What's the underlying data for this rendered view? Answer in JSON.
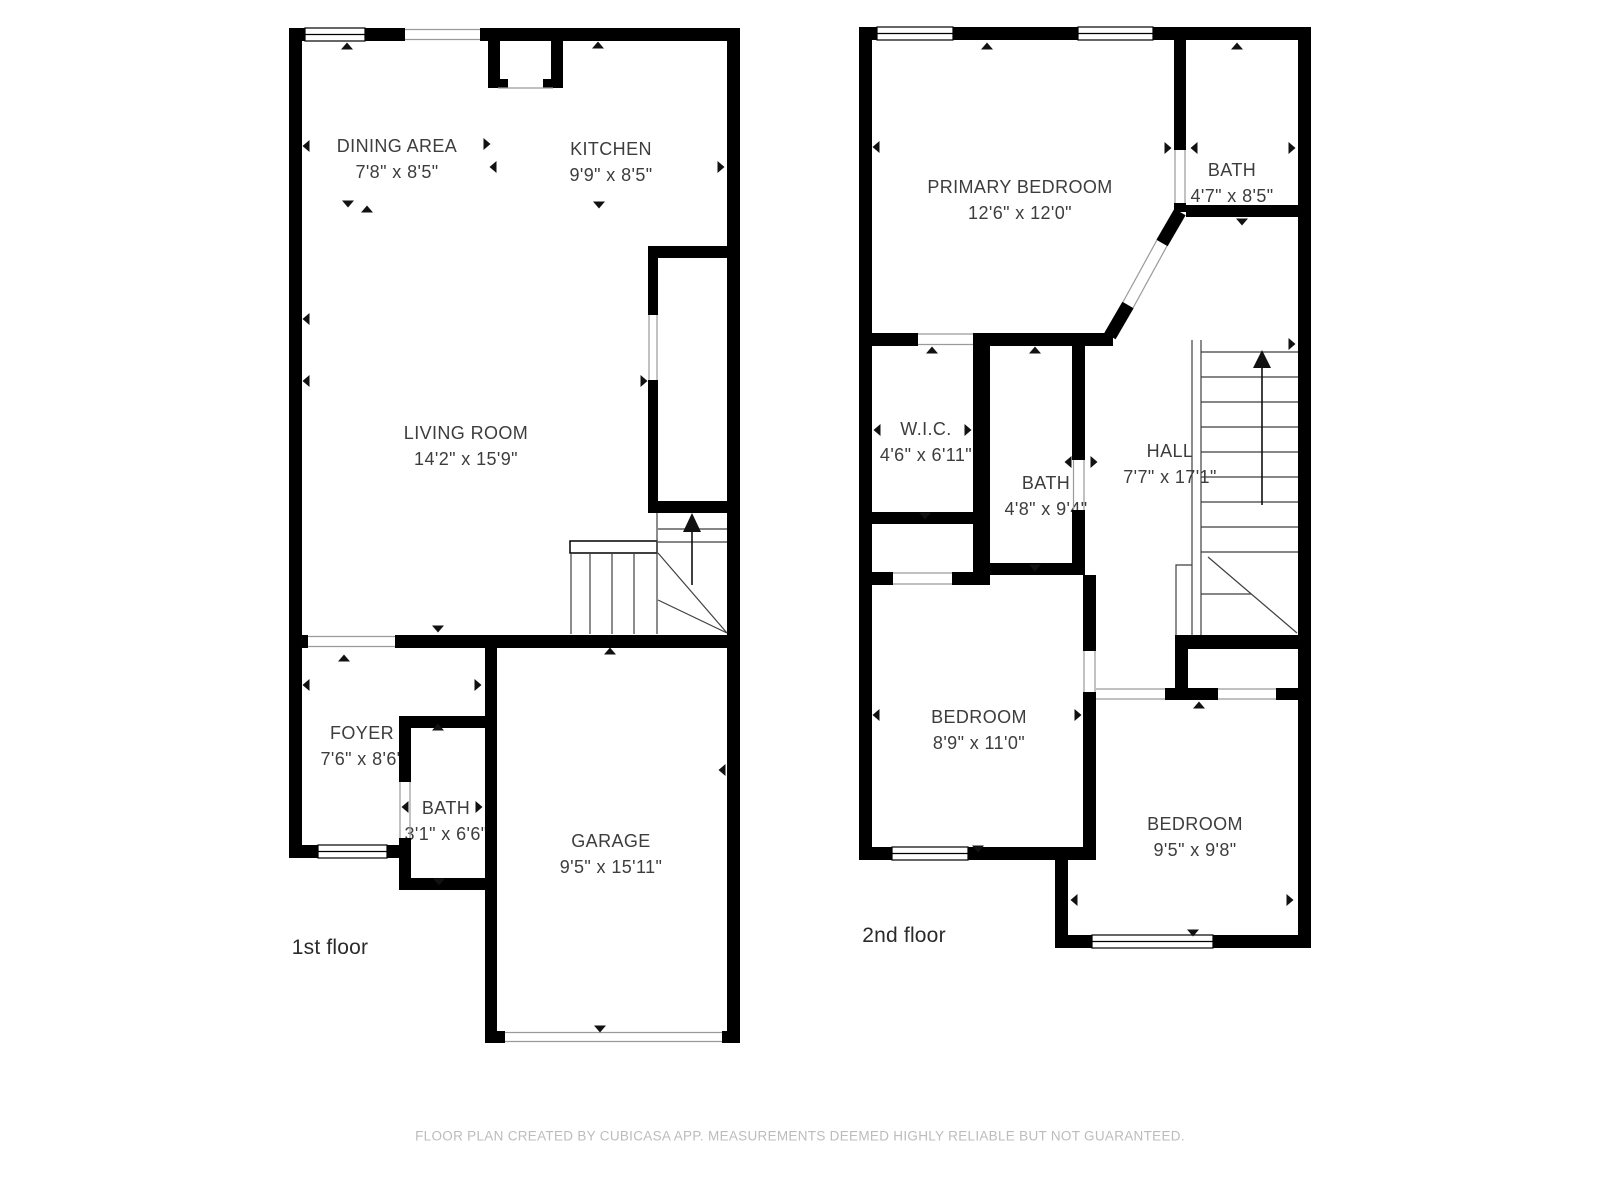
{
  "floors": [
    {
      "label": "1st floor",
      "rooms": [
        {
          "name": "DINING AREA",
          "dims": "7'8\" x 8'5\""
        },
        {
          "name": "KITCHEN",
          "dims": "9'9\" x 8'5\""
        },
        {
          "name": "LIVING ROOM",
          "dims": "14'2\" x 15'9\""
        },
        {
          "name": "FOYER",
          "dims": "7'6\" x 8'6\""
        },
        {
          "name": "BATH",
          "dims": "3'1\" x 6'6\""
        },
        {
          "name": "GARAGE",
          "dims": "9'5\" x 15'11\""
        }
      ]
    },
    {
      "label": "2nd floor",
      "rooms": [
        {
          "name": "PRIMARY BEDROOM",
          "dims": "12'6\" x 12'0\""
        },
        {
          "name": "BATH",
          "dims": "4'7\" x 8'5\""
        },
        {
          "name": "W.I.C.",
          "dims": "4'6\" x 6'11\""
        },
        {
          "name": "BATH",
          "dims": "4'8\" x 9'4\""
        },
        {
          "name": "HALL",
          "dims": "7'7\" x 17'1\""
        },
        {
          "name": "BEDROOM",
          "dims": "8'9\" x 11'0\""
        },
        {
          "name": "BEDROOM",
          "dims": "9'5\" x 9'8\""
        }
      ]
    }
  ],
  "footer": {
    "disclaimer": "FLOOR PLAN CREATED BY CUBICASA APP. MEASUREMENTS DEEMED HIGHLY RELIABLE BUT NOT GUARANTEED."
  },
  "colors": {
    "wall": "#000000",
    "room_label": "#3d3d3d",
    "floor_label": "#2b2b2b",
    "disclaimer": "#bcbcbc"
  }
}
